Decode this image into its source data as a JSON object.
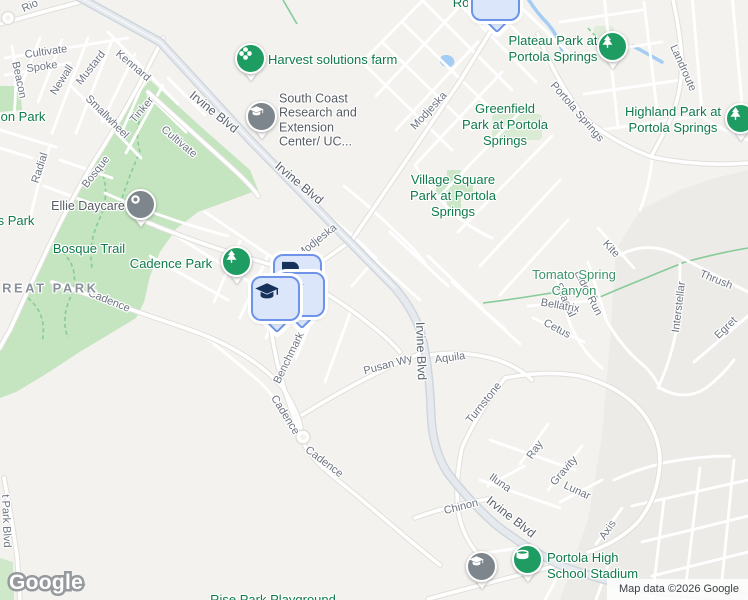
{
  "map": {
    "logo": "Google",
    "attribution": "Map data ©2026 Google",
    "colors": {
      "background": "#f4f2ee",
      "open_land": "#edebe7",
      "park_fill": "#c4e5bf",
      "water": "#a3cdf4",
      "trail": "#86cb98",
      "green_pin": "#1e9c61",
      "gray_pin": "#7e868d",
      "square_pin_fill": "#dbe6fb",
      "square_pin_border": "#6f93e8",
      "square_pin_icon": "#16325a",
      "park_text": "#0f7b4a",
      "road_text": "#6d7480"
    },
    "labels": [
      {
        "name": "road-label-rio",
        "text": "Rio",
        "x": 30,
        "y": 6,
        "rot": -25,
        "kind": "road"
      },
      {
        "name": "road-label-cultivate-1",
        "text": "Cultivate",
        "x": 46,
        "y": 52,
        "rot": -8,
        "kind": "road"
      },
      {
        "name": "road-label-spoke",
        "text": "Spoke",
        "x": 42,
        "y": 67,
        "rot": -8,
        "kind": "road"
      },
      {
        "name": "road-label-beacon",
        "text": "Beacon",
        "x": 19,
        "y": 80,
        "rot": 78,
        "kind": "road"
      },
      {
        "name": "road-label-newall",
        "text": "Newall",
        "x": 62,
        "y": 80,
        "rot": -58,
        "kind": "road"
      },
      {
        "name": "road-label-mustard",
        "text": "Mustard",
        "x": 91,
        "y": 68,
        "rot": -52,
        "kind": "road"
      },
      {
        "name": "road-label-kennard",
        "text": "Kennard",
        "x": 133,
        "y": 66,
        "rot": 40,
        "kind": "road"
      },
      {
        "name": "road-label-smallwheel",
        "text": "Smallwheel",
        "x": 107,
        "y": 117,
        "rot": 45,
        "kind": "road"
      },
      {
        "name": "road-label-tinker",
        "text": "Tinker",
        "x": 142,
        "y": 110,
        "rot": -50,
        "kind": "road"
      },
      {
        "name": "road-label-radial",
        "text": "Radial",
        "x": 40,
        "y": 168,
        "rot": -72,
        "kind": "road"
      },
      {
        "name": "road-label-bosque",
        "text": "Bosque",
        "x": 96,
        "y": 172,
        "rot": -52,
        "kind": "road"
      },
      {
        "name": "road-label-cultivate-2",
        "text": "Cultivate",
        "x": 179,
        "y": 142,
        "rot": 40,
        "kind": "road"
      },
      {
        "name": "road-label-modjeska-1",
        "text": "Modjeska",
        "x": 429,
        "y": 111,
        "rot": -47,
        "kind": "road"
      },
      {
        "name": "road-label-modjeska-2",
        "text": "Modjeska",
        "x": 317,
        "y": 241,
        "rot": -38,
        "kind": "road"
      },
      {
        "name": "road-label-landroute",
        "text": "Landroute",
        "x": 683,
        "y": 68,
        "rot": 66,
        "kind": "road"
      },
      {
        "name": "road-label-portola-springs",
        "text": "Portola Springs",
        "x": 577,
        "y": 112,
        "rot": 49,
        "kind": "road"
      },
      {
        "name": "road-label-spacial",
        "text": "Spacial",
        "x": 565,
        "y": 300,
        "rot": 66,
        "kind": "road"
      },
      {
        "name": "road-label-eider-run",
        "text": "Eider Run",
        "x": 588,
        "y": 293,
        "rot": 63,
        "kind": "road"
      },
      {
        "name": "road-label-kite",
        "text": "Kite",
        "x": 611,
        "y": 249,
        "rot": 47,
        "kind": "road"
      },
      {
        "name": "road-label-thrush",
        "text": "Thrush",
        "x": 716,
        "y": 280,
        "rot": 22,
        "kind": "road"
      },
      {
        "name": "road-label-interstellar",
        "text": "Interstellar",
        "x": 679,
        "y": 307,
        "rot": -83,
        "kind": "road"
      },
      {
        "name": "road-label-egret",
        "text": "Egret",
        "x": 726,
        "y": 328,
        "rot": -44,
        "kind": "road"
      },
      {
        "name": "road-label-bellatrix",
        "text": "Bellatrix",
        "x": 560,
        "y": 306,
        "rot": 10,
        "kind": "road"
      },
      {
        "name": "road-label-cetus",
        "text": "Cetus",
        "x": 557,
        "y": 329,
        "rot": 28,
        "kind": "road"
      },
      {
        "name": "road-label-cadence-1",
        "text": "Cadence",
        "x": 109,
        "y": 301,
        "rot": 22,
        "kind": "road"
      },
      {
        "name": "road-label-cadence-2",
        "text": "Cadence",
        "x": 285,
        "y": 415,
        "rot": 58,
        "kind": "road"
      },
      {
        "name": "road-label-cadence-3",
        "text": "Cadence",
        "x": 324,
        "y": 462,
        "rot": 37,
        "kind": "road"
      },
      {
        "name": "road-label-benchmark",
        "text": "Benchmark",
        "x": 289,
        "y": 358,
        "rot": -64,
        "kind": "road"
      },
      {
        "name": "road-label-pusan-wy",
        "text": "Pusan Wy",
        "x": 388,
        "y": 365,
        "rot": -15,
        "kind": "road"
      },
      {
        "name": "road-label-aquila",
        "text": "Aquila",
        "x": 450,
        "y": 358,
        "rot": -8,
        "kind": "road"
      },
      {
        "name": "road-label-turnstone",
        "text": "Turnstone",
        "x": 484,
        "y": 403,
        "rot": -51,
        "kind": "road"
      },
      {
        "name": "road-label-ray",
        "text": "Ray",
        "x": 535,
        "y": 450,
        "rot": -55,
        "kind": "road"
      },
      {
        "name": "road-label-gravity",
        "text": "Gravity",
        "x": 564,
        "y": 471,
        "rot": -49,
        "kind": "road"
      },
      {
        "name": "road-label-lunar",
        "text": "Lunar",
        "x": 577,
        "y": 491,
        "rot": 25,
        "kind": "road"
      },
      {
        "name": "road-label-iluna",
        "text": "Iluna",
        "x": 500,
        "y": 483,
        "rot": 35,
        "kind": "road"
      },
      {
        "name": "road-label-axis",
        "text": "Axis",
        "x": 608,
        "y": 530,
        "rot": -56,
        "kind": "road"
      },
      {
        "name": "road-label-chinon",
        "text": "Chinon",
        "x": 461,
        "y": 507,
        "rot": -14,
        "kind": "road"
      },
      {
        "name": "road-label-park-blvd",
        "text": "t Park Blvd",
        "x": 6,
        "y": 521,
        "rot": 88,
        "kind": "road"
      },
      {
        "name": "road-label-irvine-blvd-1",
        "text": "Irvine Blvd",
        "x": 214,
        "y": 112,
        "rot": 39,
        "kind": "road-major"
      },
      {
        "name": "road-label-irvine-blvd-2",
        "text": "Irvine Blvd",
        "x": 299,
        "y": 183,
        "rot": 40,
        "kind": "road-major"
      },
      {
        "name": "road-label-irvine-blvd-3",
        "text": "Irvine Blvd",
        "x": 421,
        "y": 351,
        "rot": 88,
        "kind": "road-major"
      },
      {
        "name": "road-label-irvine-blvd-4",
        "text": "Irvine Blvd",
        "x": 511,
        "y": 517,
        "rot": 38,
        "kind": "road-major"
      },
      {
        "name": "park-label-on-park",
        "text": "on Park",
        "x": 23,
        "y": 117,
        "rot": 0,
        "kind": "park"
      },
      {
        "name": "park-label-s-park",
        "text": "s Park",
        "x": 16,
        "y": 221,
        "rot": 0,
        "kind": "park"
      },
      {
        "name": "park-label-bosque-trail",
        "text": "Bosque Trail",
        "x": 89,
        "y": 249,
        "rot": 0,
        "kind": "park"
      },
      {
        "name": "park-label-cadence-park",
        "text": "Cadence Park",
        "x": 171,
        "y": 264,
        "rot": 0,
        "kind": "park"
      },
      {
        "name": "poi-label-harvest-farm",
        "text": "Harvest solutions farm",
        "x": 268,
        "y": 60,
        "rot": 0,
        "kind": "park",
        "align": "left"
      },
      {
        "name": "park-label-plateau",
        "lines": [
          "Plateau Park at",
          "Portola Springs"
        ],
        "x": 553,
        "y": 49,
        "rot": 0,
        "kind": "park"
      },
      {
        "name": "park-label-greenfield",
        "lines": [
          "Greenfield",
          "Park at Portola",
          "Springs"
        ],
        "x": 505,
        "y": 125,
        "rot": 0,
        "kind": "park"
      },
      {
        "name": "park-label-highland",
        "lines": [
          "Highland Park at",
          "Portola Springs"
        ],
        "x": 673,
        "y": 120,
        "rot": 0,
        "kind": "park"
      },
      {
        "name": "park-label-village-square",
        "lines": [
          "Village Square",
          "Park at Portola",
          "Springs"
        ],
        "x": 453,
        "y": 196,
        "rot": 0,
        "kind": "park"
      },
      {
        "name": "poi-label-portola-stadium",
        "lines": [
          "Portola High",
          "School Stadium"
        ],
        "x": 547,
        "y": 566,
        "rot": 0,
        "kind": "park",
        "align": "left"
      },
      {
        "name": "park-label-rise-park",
        "text": "Rise Park Playground",
        "x": 273,
        "y": 600,
        "rot": 0,
        "kind": "park"
      },
      {
        "name": "park-label-ro-partial",
        "text": "Ro",
        "x": 461,
        "y": 3,
        "rot": 0,
        "kind": "park"
      },
      {
        "name": "area-label-tomato-spring",
        "lines": [
          "Tomato Spring",
          "Canyon"
        ],
        "x": 574,
        "y": 283,
        "rot": 0,
        "kind": "canyon"
      },
      {
        "name": "area-label-great-park",
        "text": "GREAT PARK",
        "x": 44,
        "y": 288,
        "rot": 0,
        "kind": "area"
      },
      {
        "name": "poi-label-south-coast",
        "lines": [
          "South Coast",
          "Research and",
          "Extension",
          "Center/ UC..."
        ],
        "x": 279,
        "y": 120,
        "rot": 0,
        "kind": "poi",
        "align": "left"
      },
      {
        "name": "poi-label-ellie-daycare",
        "text": "Ellie Daycare",
        "x": 88,
        "y": 206,
        "rot": 0,
        "kind": "poi"
      }
    ],
    "pins": [
      {
        "name": "school-result-pin-top",
        "style": "square",
        "icon": "grad-cap",
        "x": 496,
        "y": -1
      },
      {
        "name": "result-pin-back",
        "style": "square",
        "icon": "p-card",
        "x": 298,
        "y": 277
      },
      {
        "name": "school-result-pin-middle",
        "style": "square",
        "icon": "grad-cap",
        "x": 301,
        "y": 295
      },
      {
        "name": "school-result-pin-front",
        "style": "square",
        "icon": "grad-cap",
        "x": 276,
        "y": 299
      },
      {
        "name": "harvest-solutions-farm-pin",
        "style": "circle",
        "color": "green",
        "icon": "flower",
        "x": 251,
        "y": 59
      },
      {
        "name": "south-coast-research-pin",
        "style": "circle",
        "color": "gray",
        "icon": "grad-cap",
        "x": 262,
        "y": 117
      },
      {
        "name": "ellie-daycare-pin",
        "style": "circle",
        "color": "gray",
        "icon": "dot",
        "x": 141,
        "y": 205
      },
      {
        "name": "cadence-park-pin",
        "style": "circle",
        "color": "green",
        "icon": "tree",
        "x": 237,
        "y": 262
      },
      {
        "name": "plateau-park-pin",
        "style": "circle",
        "color": "green",
        "icon": "tree",
        "x": 613,
        "y": 47
      },
      {
        "name": "highland-park-pin",
        "style": "circle",
        "color": "green",
        "icon": "tree",
        "x": 741,
        "y": 119
      },
      {
        "name": "portola-stadium-pin",
        "style": "circle",
        "color": "green",
        "icon": "stadium",
        "x": 528,
        "y": 560
      },
      {
        "name": "school-pin-bottom",
        "style": "circle",
        "color": "gray",
        "icon": "grad-cap",
        "x": 482,
        "y": 567
      }
    ]
  }
}
